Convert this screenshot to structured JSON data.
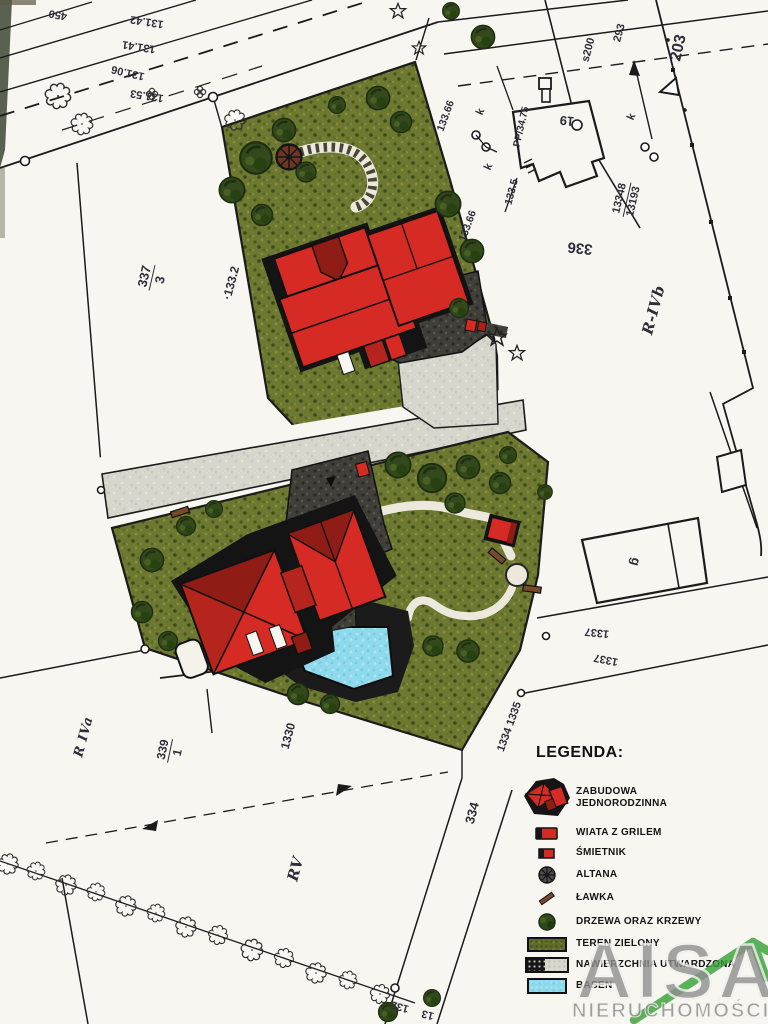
{
  "legend": {
    "title": "LEGENDA:",
    "items": [
      {
        "icon": "house-cluster-icon",
        "label": "ZABUDOWA JEDNORODZINNA"
      },
      {
        "icon": "grill-shelter-icon",
        "label": "WIATA Z GRILEM"
      },
      {
        "icon": "trash-shed-icon",
        "label": "ŚMIETNIK"
      },
      {
        "icon": "gazebo-icon",
        "label": "ALTANA"
      },
      {
        "icon": "bench-icon",
        "label": "ŁAWKA"
      },
      {
        "icon": "trees-icon",
        "label": "DRZEWA ORAZ KRZEWY"
      },
      {
        "icon": "green-area-icon",
        "label": "TEREN ZIELONY"
      },
      {
        "icon": "paved-surface-icon",
        "label": "NAWIERZCHNIA UTWARDZONA"
      },
      {
        "icon": "pool-icon",
        "label": "BASEN"
      }
    ]
  },
  "watermark": {
    "brand": "AISA",
    "subtitle": "NIERUCHOMOŚCI"
  },
  "map_labels": [
    {
      "t": "450",
      "x": 58,
      "y": 14,
      "r": 190,
      "s": 11
    },
    {
      "t": "131.42",
      "x": 147,
      "y": 21,
      "r": 189,
      "s": 11
    },
    {
      "t": "131.41",
      "x": 139,
      "y": 46,
      "r": 189,
      "s": 11
    },
    {
      "t": "131.06",
      "x": 128,
      "y": 72,
      "r": 193,
      "s": 11
    },
    {
      "t": "131.53",
      "x": 147,
      "y": 95,
      "r": 189,
      "s": 11
    },
    {
      "type": "fraction",
      "t": "337",
      "den": "3",
      "x": 152,
      "y": 278,
      "r": 283,
      "s": 13
    },
    {
      "t": "·133.2",
      "x": 231,
      "y": 283,
      "r": 285,
      "s": 12
    },
    {
      "t": "133.66",
      "x": 446,
      "y": 116,
      "r": 290,
      "s": 10.5
    },
    {
      "t": "k",
      "x": 481,
      "y": 112,
      "r": 295,
      "s": 11
    },
    {
      "t": "k",
      "x": 489,
      "y": 167,
      "r": 295,
      "s": 11
    },
    {
      "t": "133.66",
      "x": 468,
      "y": 226,
      "r": 290,
      "s": 10.5
    },
    {
      "t": "133.5",
      "x": 512,
      "y": 192,
      "r": 285,
      "s": 10.5
    },
    {
      "t": "PP/34.75",
      "x": 522,
      "y": 127,
      "r": 283,
      "s": 10
    },
    {
      "t": "19",
      "x": 567,
      "y": 121,
      "r": 186,
      "s": 13
    },
    {
      "t": "s200",
      "x": 589,
      "y": 50,
      "r": 285,
      "s": 11
    },
    {
      "t": "293",
      "x": 620,
      "y": 33,
      "r": 285,
      "s": 11
    },
    {
      "t": "k",
      "x": 632,
      "y": 117,
      "r": 295,
      "s": 11
    },
    {
      "t": "203",
      "x": 679,
      "y": 48,
      "r": 283,
      "s": 16
    },
    {
      "type": "fraction",
      "t": "13348",
      "den": "13193",
      "x": 627,
      "y": 200,
      "r": 283,
      "s": 11
    },
    {
      "t": "336",
      "x": 580,
      "y": 248,
      "r": 186,
      "s": 15
    },
    {
      "t": "R-IVb",
      "x": 654,
      "y": 310,
      "r": 285,
      "s": 15,
      "cls": "soil"
    },
    {
      "t": "g",
      "x": 636,
      "y": 562,
      "r": 105,
      "s": 13
    },
    {
      "t": "1337",
      "x": 597,
      "y": 632,
      "r": 186,
      "s": 11
    },
    {
      "t": "1337",
      "x": 606,
      "y": 659,
      "r": 191,
      "s": 11
    },
    {
      "t": "1334 1335",
      "x": 510,
      "y": 727,
      "r": 290,
      "s": 11
    },
    {
      "t": "334",
      "x": 472,
      "y": 813,
      "r": 285,
      "s": 13
    },
    {
      "t": "RV",
      "x": 296,
      "y": 869,
      "r": 285,
      "s": 15,
      "cls": "soil"
    },
    {
      "t": "R IVa",
      "x": 84,
      "y": 737,
      "r": 285,
      "s": 13,
      "cls": "soil"
    },
    {
      "type": "fraction",
      "t": "339",
      "den": "1",
      "x": 170,
      "y": 751,
      "r": 282,
      "s": 12
    },
    {
      "t": "1330",
      "x": 288,
      "y": 736,
      "r": 285,
      "s": 12
    },
    {
      "t": "132",
      "x": 400,
      "y": 1006,
      "r": 195,
      "s": 11
    },
    {
      "t": "13",
      "x": 428,
      "y": 1014,
      "r": 195,
      "s": 11
    }
  ],
  "colors": {
    "paper": "#f7f6f1",
    "line": "#1b1b1b",
    "label_ink": "#2e2e3a",
    "green_area": "#6d7830",
    "road_gray": "#d6d5cc",
    "dark_paving": "#413f3a",
    "pool_blue": "#8ed9ec",
    "roof_red": "#d62a24",
    "roof_dark": "#8f1d16",
    "roof_mid": "#b5251d",
    "tree_green": "#33491c",
    "brand_green": "#35a035",
    "watermark_gray": "#8f8f8f"
  }
}
